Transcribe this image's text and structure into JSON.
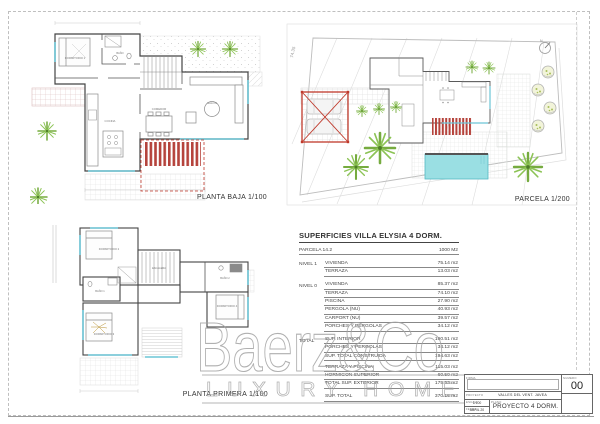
{
  "planta_baja": {
    "label": "PLANTA BAJA 1/100",
    "rooms": {
      "dormitorio1": "DORMITORIO 1",
      "bano": "BAÑO",
      "cocina": "COCINA",
      "comedor": "COMEDOR",
      "salon": "SALON"
    }
  },
  "planta_primera": {
    "label": "PLANTA PRIMERA 1/100",
    "rooms": {
      "dormitorio2": "DORMITORIO 2",
      "escalera": "ESCALERA",
      "bano1": "BAÑO 1",
      "dormitorio3": "DORMITORIO 3",
      "bano2": "BAÑO 2",
      "dormitorio4": "DORMITORIO 4"
    }
  },
  "parcela": {
    "label": "PARCELA 1/200",
    "boundary_dim": "74.35",
    "north": "N"
  },
  "areas_table": {
    "title": "SUPERFICIES VILLA ELYSIA 4 DORM.",
    "rows": [
      {
        "group": "PARCELA 14.2",
        "name": "",
        "value": "1000 M2"
      },
      {
        "group": "NIVEL 1",
        "name": "VIVIENDA",
        "value": "75.14 m2"
      },
      {
        "group": "",
        "name": "TERRAZA",
        "value": "13.03 m2"
      },
      {
        "group": "NIVEL 0",
        "name": "VIVIENDA",
        "value": "85.37 m2"
      },
      {
        "group": "",
        "name": "TERRAZA",
        "value": "74.10 m2"
      },
      {
        "group": "",
        "name": "PISCINA",
        "value": "27.90 m2"
      },
      {
        "group": "",
        "name": "PERGOLA (NU)",
        "value": "40.93 m2"
      },
      {
        "group": "",
        "name": "CARPORT (NU)",
        "value": "39.57 m2"
      },
      {
        "group": "",
        "name": "PORCHES Y PERGOLAS",
        "value": "34.12 m2"
      },
      {
        "group": "TOTAL",
        "name": "SUP. INTERIOR",
        "value": "160.51 m2"
      },
      {
        "group": "",
        "name": "PORCHES Y PERGOLAS",
        "value": "34.12 m2"
      },
      {
        "group": "",
        "name": "SUP. TOTAL CONSTRUIDA",
        "value": "194.63 m2"
      },
      {
        "group": "",
        "name": "TERRAZA Y PISCINA",
        "value": "115.03 m2"
      },
      {
        "group": "",
        "name": "HORMIGON SUPERIOR",
        "value": "60.50 m2"
      },
      {
        "group": "",
        "name": "TOTAL SUP. EXTERIOR",
        "value": "175.53 m2"
      },
      {
        "group": "",
        "name": "SUP. TOTAL",
        "value": "370.16 m2"
      }
    ]
  },
  "watermark": {
    "brand": "Baerz&Co",
    "tagline": "LUXURY HOMES"
  },
  "title_block": {
    "firma_label": "FIRMA",
    "proyecto_label": "PROYECTO",
    "proyecto_value": "VALLES DEL VENT. JAVEA",
    "escala_label": "ESCALA",
    "escala_value": "1/100",
    "fecha_label": "FECHA",
    "fecha_value": "ABRIL 20",
    "plano_label": "PLANO",
    "plano_value": "PROYECTO 4 DORM.",
    "numero_label": "NUMERO",
    "numero_value": "00"
  }
}
